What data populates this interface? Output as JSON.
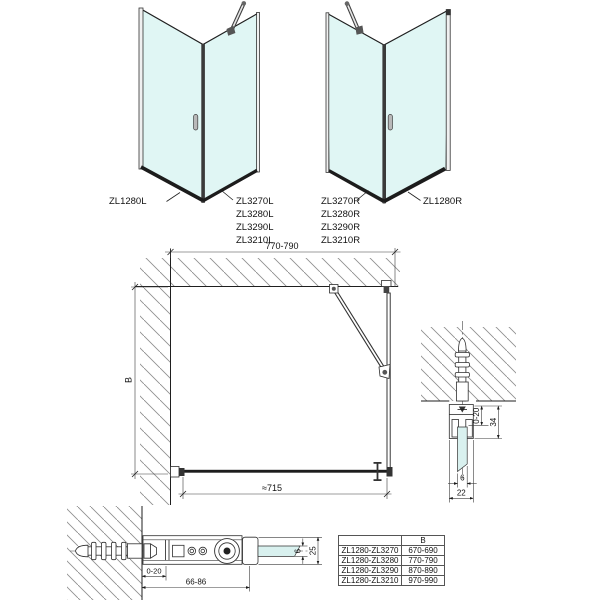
{
  "labels": {
    "left_unit": {
      "door": "ZL1280L",
      "side": [
        "ZL3270L",
        "ZL3280L",
        "ZL3290L",
        "ZL3210L"
      ]
    },
    "right_unit": {
      "door": "ZL1280R",
      "side": [
        "ZL3270R",
        "ZL3280R",
        "ZL3290R",
        "ZL3210R"
      ]
    }
  },
  "plan": {
    "width": "770-790",
    "depth": "B",
    "glass_width": "≈715"
  },
  "section_wall_profile": {
    "adjust": "0-20",
    "height": "34",
    "glass": "6",
    "width": "22"
  },
  "section_wall_bracket": {
    "adjust": "0-20",
    "length": "66-86",
    "glass": "6",
    "height": "25"
  },
  "size_table": {
    "header_b": "B",
    "rows": [
      {
        "model": "ZL1280-ZL3270",
        "b": "670-690"
      },
      {
        "model": "ZL1280-ZL3280",
        "b": "770-790"
      },
      {
        "model": "ZL1280-ZL3290",
        "b": "870-890"
      },
      {
        "model": "ZL1280-ZL3210",
        "b": "970-990"
      }
    ]
  },
  "colors": {
    "glass": "#e0f6f4",
    "line": "#1a1a1a",
    "hatch": "#8f8f8f"
  }
}
